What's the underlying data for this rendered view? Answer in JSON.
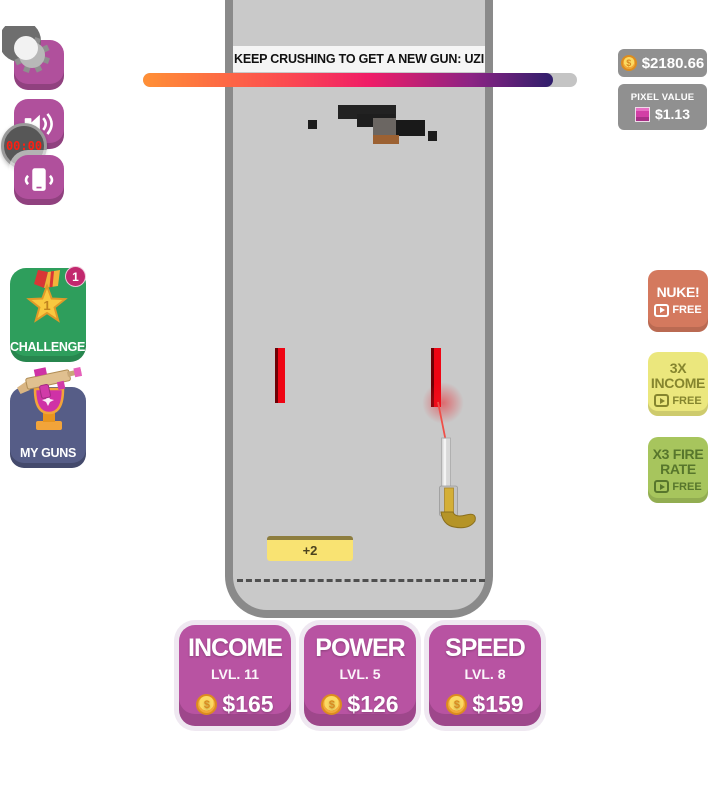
{
  "banner": {
    "text": "KEEP CRUSHING TO GET A NEW GUN: UZI"
  },
  "progress": {
    "percent": 94.5
  },
  "hud": {
    "wallet": {
      "amount": "$2180.66"
    },
    "pixel_value": {
      "label": "PIXEL VALUE",
      "amount": "$1.13"
    },
    "timer": {
      "value": "00:00"
    }
  },
  "left_menu": {
    "challenges": {
      "label": "CHALLENGES",
      "badge": "1",
      "star_text": "1"
    },
    "my_guns": {
      "label": "MY GUNS"
    }
  },
  "boosters": [
    {
      "title": "NUKE!",
      "cta": "FREE"
    },
    {
      "title": "3X INCOME",
      "cta": "FREE"
    },
    {
      "title": "X3 FIRE RATE",
      "cta": "FREE"
    }
  ],
  "game": {
    "pickup_label": "+2"
  },
  "upgrades": [
    {
      "title": "INCOME",
      "level": "LVL. 11",
      "price": "$165"
    },
    {
      "title": "POWER",
      "level": "LVL. 5",
      "price": "$126"
    },
    {
      "title": "SPEED",
      "level": "LVL. 8",
      "price": "$159"
    }
  ],
  "icons": {
    "coin_symbol": "$"
  },
  "colors": {
    "accent_magenta": "#b0509c",
    "upgrade_purple": "#b853a2",
    "nuke_red": "#d4795e",
    "income_yellow": "#ebe77d",
    "firerate_green": "#a7c55d",
    "challenges_green": "#2e9e5c",
    "myguns_blue": "#565d87",
    "laser_red": "#ef0413",
    "pixel_swatch": "#d23fa6",
    "frame_border": "#8a8a8a",
    "frame_bg": "#c9c9c9"
  }
}
